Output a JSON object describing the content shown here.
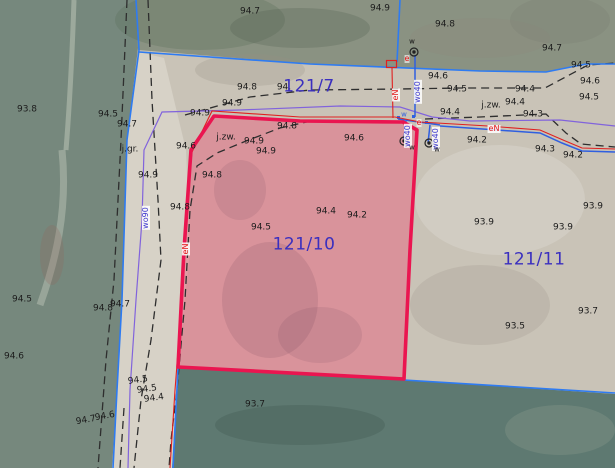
{
  "map": {
    "kind": "cadastral-aerial-map",
    "highlighted_parcel": "121/10",
    "colors": {
      "parcel_highlight_border": "#ea1550",
      "parcel_highlight_fill": "rgba(233,100,128,0.5)",
      "parcel_number_text": "#3a2fbf",
      "cadastral_boundary_blue": "#2e7bf2",
      "utility_water_blue": "#2f5fe0",
      "utility_power_red": "#e02020",
      "boundary_violet": "#8163dc",
      "dashed_line": "#2e2e2e",
      "field_green": "#76887d",
      "field_teal": "#5e7971",
      "soil": "#c9c3b7"
    },
    "parcels": [
      {
        "id": "121/7"
      },
      {
        "id": "121/10",
        "highlighted": true
      },
      {
        "id": "121/11"
      }
    ],
    "labels": [
      {
        "t": "94.7",
        "k": "elev",
        "x": 250,
        "y": 12
      },
      {
        "t": "94.9",
        "k": "elev",
        "x": 380,
        "y": 9
      },
      {
        "t": "94.8",
        "k": "elev",
        "x": 445,
        "y": 25
      },
      {
        "t": "94.7",
        "k": "elev",
        "x": 552,
        "y": 49
      },
      {
        "t": "94.5",
        "k": "elev",
        "x": 581,
        "y": 66
      },
      {
        "t": "93.8",
        "k": "elev",
        "x": 27,
        "y": 110
      },
      {
        "t": "94.5",
        "k": "elev",
        "x": 108,
        "y": 115
      },
      {
        "t": "94.7",
        "k": "elev",
        "x": 127,
        "y": 125
      },
      {
        "t": "94.8",
        "k": "elev",
        "x": 247,
        "y": 88
      },
      {
        "t": "94.",
        "k": "elev",
        "x": 284,
        "y": 88
      },
      {
        "t": "94.9",
        "k": "elev",
        "x": 232,
        "y": 104
      },
      {
        "t": "94.9",
        "k": "elev",
        "x": 200,
        "y": 114
      },
      {
        "t": "94.6",
        "k": "elev",
        "x": 438,
        "y": 77
      },
      {
        "t": "94.5",
        "k": "elev",
        "x": 457,
        "y": 90
      },
      {
        "t": "94.4",
        "k": "elev",
        "x": 525,
        "y": 90
      },
      {
        "t": "94.6",
        "k": "elev",
        "x": 590,
        "y": 82
      },
      {
        "t": "94.5",
        "k": "elev",
        "x": 589,
        "y": 98
      },
      {
        "t": "94.4",
        "k": "elev",
        "x": 515,
        "y": 103
      },
      {
        "t": "94.4",
        "k": "elev",
        "x": 450,
        "y": 113
      },
      {
        "t": "94.3",
        "k": "elev",
        "x": 533,
        "y": 115
      },
      {
        "t": "94.9",
        "k": "elev",
        "x": 148,
        "y": 176
      },
      {
        "t": "94.6",
        "k": "elev",
        "x": 186,
        "y": 147
      },
      {
        "t": "94.9",
        "k": "elev",
        "x": 254,
        "y": 142
      },
      {
        "t": "94.9",
        "k": "elev",
        "x": 266,
        "y": 152
      },
      {
        "t": "94.8",
        "k": "elev",
        "x": 287,
        "y": 127
      },
      {
        "t": "94.6",
        "k": "elev",
        "x": 354,
        "y": 139
      },
      {
        "t": "94.8",
        "k": "elev",
        "x": 212,
        "y": 176
      },
      {
        "t": "94.8",
        "k": "elev",
        "x": 180,
        "y": 208
      },
      {
        "t": "94.4",
        "k": "elev",
        "x": 326,
        "y": 212
      },
      {
        "t": "94.2",
        "k": "elev",
        "x": 357,
        "y": 216
      },
      {
        "t": "94.5",
        "k": "elev",
        "x": 261,
        "y": 228
      },
      {
        "t": "94.2",
        "k": "elev",
        "x": 477,
        "y": 141
      },
      {
        "t": "94.3",
        "k": "elev",
        "x": 545,
        "y": 150
      },
      {
        "t": "94.2",
        "k": "elev",
        "x": 573,
        "y": 156
      },
      {
        "t": "93.9",
        "k": "elev",
        "x": 593,
        "y": 207
      },
      {
        "t": "93.9",
        "k": "elev",
        "x": 484,
        "y": 223
      },
      {
        "t": "93.9",
        "k": "elev",
        "x": 563,
        "y": 228
      },
      {
        "t": "93.7",
        "k": "elev",
        "x": 588,
        "y": 312
      },
      {
        "t": "93.5",
        "k": "elev",
        "x": 515,
        "y": 327
      },
      {
        "t": "94.5",
        "k": "elev",
        "x": 22,
        "y": 300
      },
      {
        "t": "94.8",
        "k": "elev",
        "x": 103,
        "y": 309
      },
      {
        "t": "94.7",
        "k": "elev",
        "x": 120,
        "y": 305
      },
      {
        "t": "94.6",
        "k": "elev",
        "x": 14,
        "y": 357
      },
      {
        "t": "94.5",
        "k": "elev",
        "x": 138,
        "y": 381,
        "r": -8
      },
      {
        "t": "94.5",
        "k": "elev",
        "x": 147,
        "y": 390,
        "r": -8
      },
      {
        "t": "94.4",
        "k": "elev",
        "x": 154,
        "y": 399,
        "r": -8
      },
      {
        "t": "94.7",
        "k": "elev",
        "x": 86,
        "y": 421,
        "r": -10
      },
      {
        "t": "94.6",
        "k": "elev",
        "x": 105,
        "y": 417,
        "r": -10
      },
      {
        "t": "93.7",
        "k": "elev",
        "x": 255,
        "y": 405
      },
      {
        "t": "j.zw.",
        "k": "note",
        "x": 226,
        "y": 138
      },
      {
        "t": "j.zw.",
        "k": "note",
        "x": 491,
        "y": 106
      },
      {
        "t": "j.gr.",
        "k": "note",
        "x": 130,
        "y": 150
      },
      {
        "t": "121/7",
        "k": "parcel",
        "x": 309,
        "y": 87
      },
      {
        "t": "121/10",
        "k": "parcel",
        "x": 304,
        "y": 245
      },
      {
        "t": "121/11",
        "k": "parcel",
        "x": 534,
        "y": 260
      },
      {
        "t": "wo40",
        "k": "wo",
        "x": 418,
        "y": 92,
        "v": true
      },
      {
        "t": "wo90",
        "k": "wo",
        "x": 146,
        "y": 218,
        "v": true
      },
      {
        "t": "wo40",
        "k": "wo",
        "x": 408,
        "y": 136,
        "v": true
      },
      {
        "t": "wo40",
        "k": "wo",
        "x": 436,
        "y": 139,
        "v": true
      },
      {
        "t": "eN",
        "k": "en",
        "x": 396,
        "y": 95,
        "v": true
      },
      {
        "t": "eN",
        "k": "en",
        "x": 186,
        "y": 249,
        "v": true
      },
      {
        "t": "eN",
        "k": "en",
        "x": 494,
        "y": 129
      },
      {
        "t": "e",
        "k": "e",
        "x": 407,
        "y": 59
      },
      {
        "t": "e",
        "k": "e",
        "x": 419,
        "y": 123
      },
      {
        "t": "w",
        "k": "w",
        "x": 412,
        "y": 42
      },
      {
        "t": "w",
        "k": "w",
        "x": 404,
        "y": 115,
        "blue": true
      },
      {
        "t": "w",
        "k": "w",
        "x": 412,
        "y": 148
      },
      {
        "t": "w",
        "k": "w",
        "x": 437,
        "y": 150
      }
    ]
  }
}
